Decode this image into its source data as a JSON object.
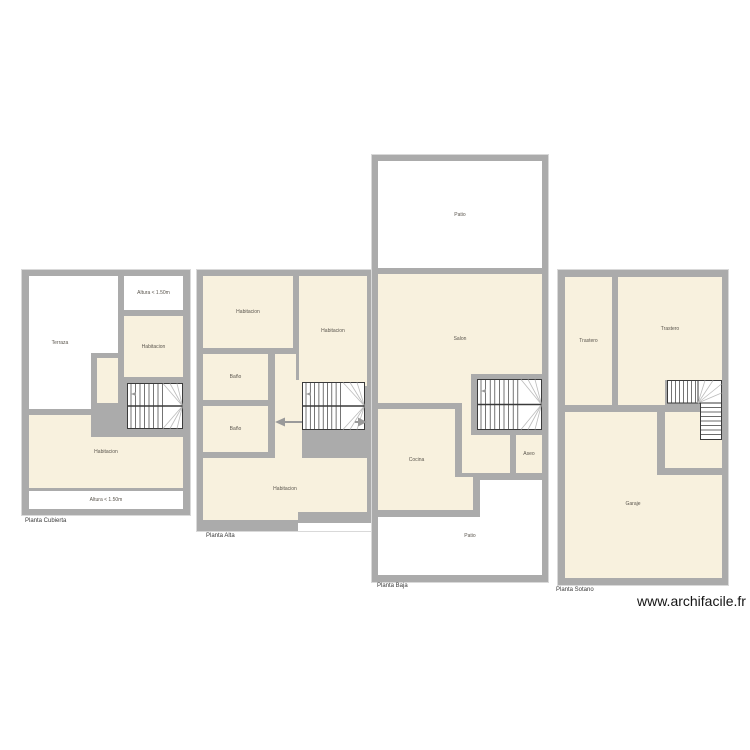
{
  "watermark": "www.archifacile.fr",
  "colors": {
    "wall": "#ababab",
    "room_fill": "#f8f1de",
    "open_area_fill": "#ffffff",
    "stair_line": "#3a3a3a",
    "winder_line": "#bcbcbc",
    "arrow": "#9a9a9a",
    "room_label": "#5b564e",
    "plan_label": "#3a3a3a"
  },
  "plans": {
    "cubierta": {
      "name": "Planta Cubierta",
      "rooms": {
        "terraza": "Terraza",
        "altura_top": "Altura < 1.50m",
        "habitacion_right": "Habitacion",
        "habitacion_main": "Habitacion",
        "altura_bottom": "Altura < 1.50m"
      }
    },
    "alta": {
      "name": "Planta Alta",
      "rooms": {
        "habitacion_tl": "Habitacion",
        "habitacion_tr": "Habitacion",
        "bano_1": "Baño",
        "bano_2": "Baño",
        "habitacion_main": "Habitacion"
      }
    },
    "baja": {
      "name": "Planta Baja",
      "rooms": {
        "patio_top": "Patio",
        "salon": "Salon",
        "cocina": "Cocina",
        "aseo": "Aseo",
        "patio_bottom": "Patio"
      }
    },
    "sotano": {
      "name": "Planta Sotano",
      "rooms": {
        "trastero_l": "Trastero",
        "trastero_r": "Trastero",
        "garaje": "Garaje"
      }
    }
  }
}
